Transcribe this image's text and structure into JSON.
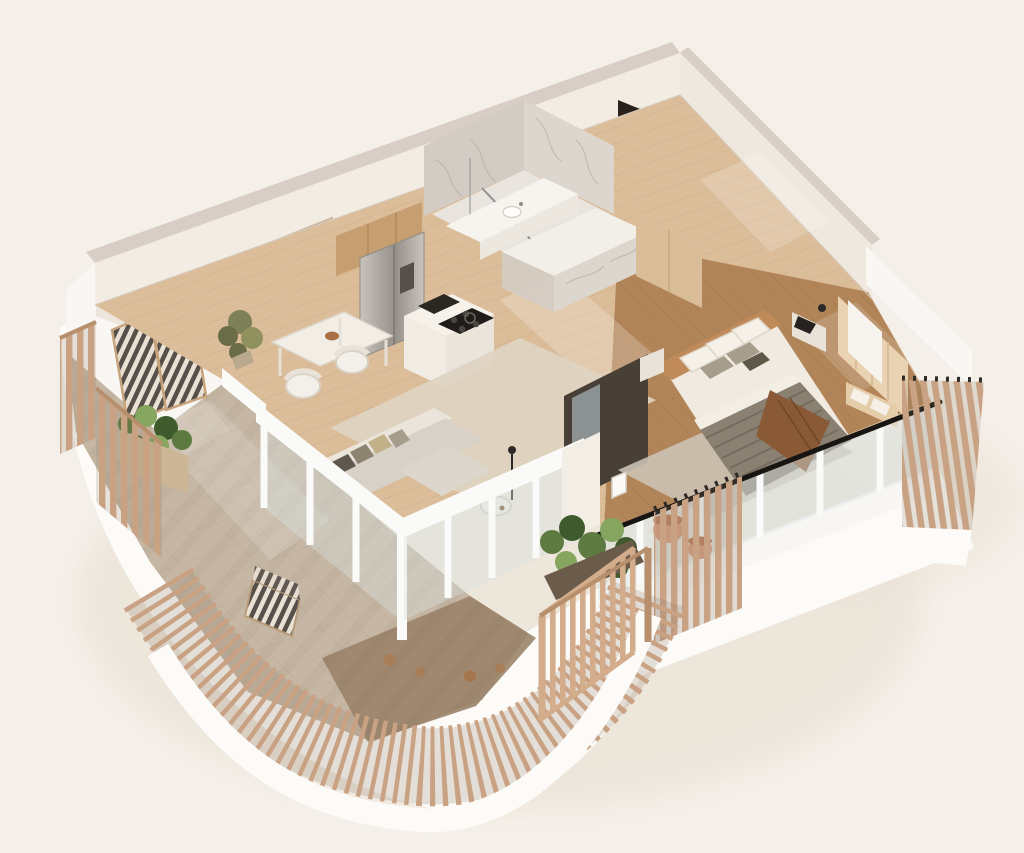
{
  "page": {
    "kind": "isometric-3d-floor-plan-render",
    "view": "cutaway aerial of a studio apartment with curved slatted balcony",
    "visible_text": ""
  },
  "scene": {
    "rooms": [
      "bathroom",
      "entry-hall",
      "kitchen",
      "dining-nook",
      "living-room",
      "bedroom",
      "balcony-terrace"
    ],
    "objects": [
      "entry-door",
      "marble-shower",
      "vanity-sink",
      "fridge",
      "cooktop",
      "kitchen-island",
      "wall-art",
      "dining-table",
      "dining-chairs",
      "indoor-plant",
      "area-rug",
      "l-shaped-sofa",
      "coffee-table",
      "media-unit",
      "double-bed",
      "nightstands",
      "bench",
      "glass-balustrade",
      "glazed-doors",
      "timber-slat-fence",
      "open-gate",
      "planters",
      "terracotta-pots",
      "striped-deck-chairs",
      "outdoor-armchair"
    ]
  },
  "colors": {
    "bg": "#f4efe8",
    "slab": "#fcfbf8",
    "shadow": "#e8dfd1",
    "wallRidge": "#d8cec6",
    "wallFace": "#f3ece3",
    "wallFace2": "#efe8de",
    "wallWhite": "#f9f7f3",
    "wallShade": "#e3dacd",
    "doorDark": "#2a211c",
    "artwork": "#dcc9b1",
    "artworkFrame": "#cbb89e",
    "woodFloor": "#dcbd9a",
    "plankLine": "#b99b78",
    "bedroomFloor": "#b08256",
    "bedroomPlank": "#8f6a46",
    "marbleLight": "#e9e4de",
    "marbleMid": "#ddd6ce",
    "marbleDark": "#d3ccc4",
    "vein": "#b3a89c",
    "vanity": "#f7f4ef",
    "cabinetWood": "#c79e6f",
    "steelA": "#c9c3bd",
    "steelB": "#96908a",
    "counter": "#f6f2ea",
    "counterSide": "#eae4da",
    "cooktop": "#1f1c19",
    "sink": "#2a2622",
    "rugLiving": "#ded4c2",
    "rugBedroom": "#ccc4b6",
    "sofaShell": "#eae4da",
    "sofaSeat": "#d7d1c7",
    "chaise": "#dcd6cc",
    "pillowDark": "#5f5850",
    "pillowOlive": "#8c8370",
    "pillowGray": "#a79d8d",
    "pillowGold": "#c2b188",
    "tableWhite": "#f2eee6",
    "bowl": "#a56f47",
    "bedLinen": "#f0eae0",
    "headboard": "#c08b58",
    "blanket": "#8b8173",
    "blanketStripe": "#6e6557",
    "sheet": "#f3eee4",
    "throw": "#8a5a36",
    "nightstand": "#e8e2d8",
    "laptop": "#26221f",
    "wardrobe": "#484037",
    "mirror": "#99a1a2",
    "benchWood": "#e5cda9",
    "accentPanel": "#ead3b2",
    "closetTan": "#d9bd99",
    "glass": "#d7e1df",
    "mullion": "#fafaf8",
    "handrail": "#181512",
    "paver": "#c6b7a4",
    "grout": "#a6937d",
    "deck": "#9a8369",
    "fenceWood": "#c9a183",
    "fenceRail": "#b78f6c",
    "fenceBackdrop": "#8d7c68",
    "gateWood": "#d3ac8c",
    "planter": "#6b5b4a",
    "planterBox": "#cdb695",
    "greenDark": "#3f5a2c",
    "green": "#5d7a40",
    "greenLight": "#86a55e",
    "oliveGreen": "#7e8157",
    "terracotta": "#d9a184",
    "terracottaDark": "#c0815f",
    "stripeDark": "#57504a",
    "stripeLight": "#e9e1d3",
    "chairFrame": "#c8a47c",
    "sun": "#ffffff"
  }
}
